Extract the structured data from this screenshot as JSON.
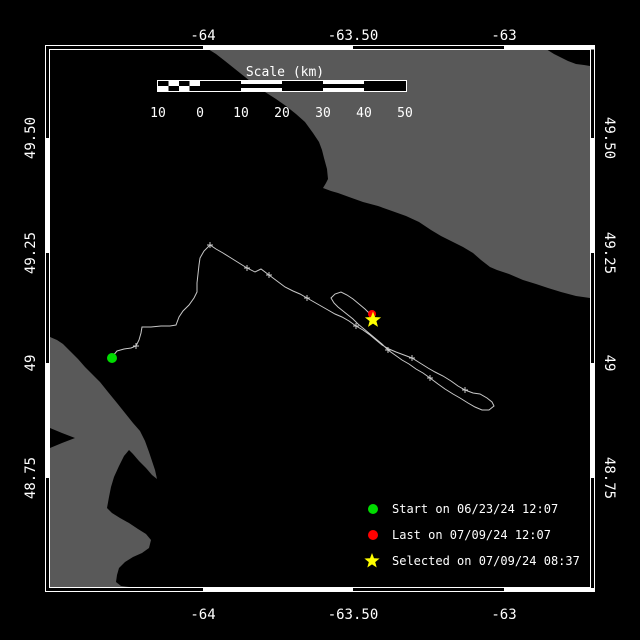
{
  "map": {
    "colors": {
      "water": "#000000",
      "land": "#595959",
      "frame": "#ffffff",
      "text": "#ffffff",
      "track": "#c8c8c8",
      "start": "#00dc00",
      "last": "#ff0000",
      "selected": "#ffff00"
    },
    "frame": {
      "lon_ticks": [
        {
          "label": "-64"
        },
        {
          "label": "-63.50"
        },
        {
          "label": "-63"
        }
      ],
      "lat_ticks": [
        {
          "label": "49.50"
        },
        {
          "label": "49.25"
        },
        {
          "label": "49"
        },
        {
          "label": "48.75"
        }
      ]
    },
    "scalebar": {
      "title": "Scale (km)",
      "labels": [
        "10",
        "0",
        "10",
        "20",
        "30",
        "40",
        "50"
      ]
    },
    "legend": {
      "items": [
        {
          "marker": "start-dot",
          "color": "#00dc00",
          "label": "Start on 06/23/24 12:07"
        },
        {
          "marker": "last-dot",
          "color": "#ff0000",
          "label": "Last on 07/09/24 12:07"
        },
        {
          "marker": "selected-star",
          "color": "#ffff00",
          "label": "Selected on 07/09/24 08:37"
        }
      ]
    },
    "geometry": {
      "track_points": [
        [
          112,
          357
        ],
        [
          117,
          351
        ],
        [
          124,
          349
        ],
        [
          131,
          348
        ],
        [
          136,
          346
        ],
        [
          139,
          340
        ],
        [
          141,
          333
        ],
        [
          142,
          327
        ],
        [
          151,
          327
        ],
        [
          161,
          326
        ],
        [
          170,
          326
        ],
        [
          176,
          325
        ],
        [
          179,
          317
        ],
        [
          183,
          311
        ],
        [
          189,
          305
        ],
        [
          194,
          298
        ],
        [
          197,
          292
        ],
        [
          197,
          283
        ],
        [
          198,
          274
        ],
        [
          199,
          265
        ],
        [
          200,
          258
        ],
        [
          204,
          251
        ],
        [
          210,
          245
        ],
        [
          216,
          249
        ],
        [
          223,
          253
        ],
        [
          231,
          258
        ],
        [
          239,
          263
        ],
        [
          247,
          268
        ],
        [
          255,
          272
        ],
        [
          261,
          269
        ],
        [
          269,
          275
        ],
        [
          277,
          281
        ],
        [
          285,
          287
        ],
        [
          293,
          291
        ],
        [
          300,
          294
        ],
        [
          307,
          298
        ],
        [
          314,
          302
        ],
        [
          321,
          306
        ],
        [
          328,
          310
        ],
        [
          335,
          314
        ],
        [
          342,
          317
        ],
        [
          349,
          321
        ],
        [
          356,
          326
        ],
        [
          363,
          330
        ],
        [
          370,
          335
        ],
        [
          376,
          340
        ],
        [
          382,
          345
        ],
        [
          389,
          349
        ],
        [
          396,
          352
        ],
        [
          404,
          355
        ],
        [
          412,
          358
        ],
        [
          420,
          363
        ],
        [
          428,
          368
        ],
        [
          435,
          372
        ],
        [
          443,
          376
        ],
        [
          451,
          381
        ],
        [
          458,
          386
        ],
        [
          465,
          390
        ],
        [
          473,
          393
        ],
        [
          480,
          394
        ],
        [
          487,
          398
        ],
        [
          492,
          402
        ],
        [
          494,
          406
        ],
        [
          489,
          410
        ],
        [
          482,
          410
        ],
        [
          475,
          407
        ],
        [
          468,
          403
        ],
        [
          460,
          398
        ],
        [
          453,
          394
        ],
        [
          445,
          389
        ],
        [
          438,
          384
        ],
        [
          430,
          378
        ],
        [
          423,
          373
        ],
        [
          416,
          369
        ],
        [
          409,
          364
        ],
        [
          402,
          360
        ],
        [
          395,
          355
        ],
        [
          388,
          350
        ],
        [
          382,
          344
        ],
        [
          376,
          339
        ],
        [
          370,
          334
        ],
        [
          364,
          329
        ],
        [
          358,
          324
        ],
        [
          353,
          319
        ],
        [
          348,
          315
        ],
        [
          343,
          311
        ],
        [
          338,
          307
        ],
        [
          334,
          303
        ],
        [
          331,
          298
        ],
        [
          335,
          294
        ],
        [
          341,
          292
        ],
        [
          347,
          295
        ],
        [
          353,
          299
        ],
        [
          359,
          304
        ],
        [
          365,
          309
        ],
        [
          369,
          313
        ],
        [
          372,
          316
        ]
      ],
      "fix_ticks": [
        [
          136,
          346
        ],
        [
          210,
          245
        ],
        [
          247,
          268
        ],
        [
          269,
          275
        ],
        [
          307,
          298
        ],
        [
          356,
          326
        ],
        [
          388,
          350
        ],
        [
          412,
          358
        ],
        [
          430,
          378
        ],
        [
          465,
          390
        ]
      ],
      "land_northeast": [
        [
          208,
          49
        ],
        [
          546,
          49
        ],
        [
          554,
          54
        ],
        [
          564,
          59
        ],
        [
          568,
          61
        ],
        [
          576,
          64
        ],
        [
          584,
          65
        ],
        [
          590,
          66
        ],
        [
          590,
          298
        ],
        [
          576,
          296
        ],
        [
          561,
          292
        ],
        [
          548,
          288
        ],
        [
          536,
          284
        ],
        [
          523,
          280
        ],
        [
          509,
          274
        ],
        [
          497,
          270
        ],
        [
          490,
          267
        ],
        [
          481,
          260
        ],
        [
          473,
          253
        ],
        [
          463,
          247
        ],
        [
          451,
          241
        ],
        [
          441,
          236
        ],
        [
          431,
          230
        ],
        [
          419,
          222
        ],
        [
          406,
          216
        ],
        [
          392,
          211
        ],
        [
          378,
          206
        ],
        [
          363,
          202
        ],
        [
          349,
          197
        ],
        [
          338,
          193
        ],
        [
          331,
          191
        ],
        [
          323,
          188
        ],
        [
          326,
          183
        ],
        [
          328,
          179
        ],
        [
          327,
          169
        ],
        [
          324,
          158
        ],
        [
          322,
          150
        ],
        [
          319,
          142
        ],
        [
          313,
          133
        ],
        [
          305,
          122
        ],
        [
          296,
          114
        ],
        [
          286,
          106
        ],
        [
          276,
          99
        ],
        [
          265,
          92
        ],
        [
          255,
          85
        ],
        [
          245,
          77
        ],
        [
          235,
          69
        ],
        [
          225,
          61
        ],
        [
          216,
          54
        ]
      ],
      "land_southwest": [
        [
          50,
          337
        ],
        [
          57,
          340
        ],
        [
          63,
          344
        ],
        [
          70,
          351
        ],
        [
          78,
          359
        ],
        [
          85,
          367
        ],
        [
          93,
          375
        ],
        [
          100,
          382
        ],
        [
          108,
          392
        ],
        [
          117,
          403
        ],
        [
          125,
          413
        ],
        [
          133,
          423
        ],
        [
          140,
          431
        ],
        [
          145,
          441
        ],
        [
          149,
          452
        ],
        [
          152,
          461
        ],
        [
          155,
          470
        ],
        [
          157,
          479
        ],
        [
          152,
          475
        ],
        [
          146,
          468
        ],
        [
          139,
          461
        ],
        [
          133,
          454
        ],
        [
          129,
          450
        ],
        [
          124,
          456
        ],
        [
          119,
          466
        ],
        [
          114,
          477
        ],
        [
          111,
          487
        ],
        [
          109,
          497
        ],
        [
          107,
          508
        ],
        [
          112,
          513
        ],
        [
          120,
          518
        ],
        [
          129,
          523
        ],
        [
          138,
          529
        ],
        [
          146,
          534
        ],
        [
          151,
          540
        ],
        [
          149,
          548
        ],
        [
          142,
          553
        ],
        [
          133,
          557
        ],
        [
          125,
          562
        ],
        [
          119,
          568
        ],
        [
          117,
          575
        ],
        [
          116,
          582
        ],
        [
          121,
          586
        ],
        [
          129,
          587
        ],
        [
          138,
          588
        ],
        [
          147,
          588
        ],
        [
          50,
          588
        ]
      ],
      "bay_wedge": [
        [
          50,
          428
        ],
        [
          62,
          433
        ],
        [
          75,
          438
        ],
        [
          62,
          443
        ],
        [
          50,
          448
        ]
      ]
    }
  }
}
